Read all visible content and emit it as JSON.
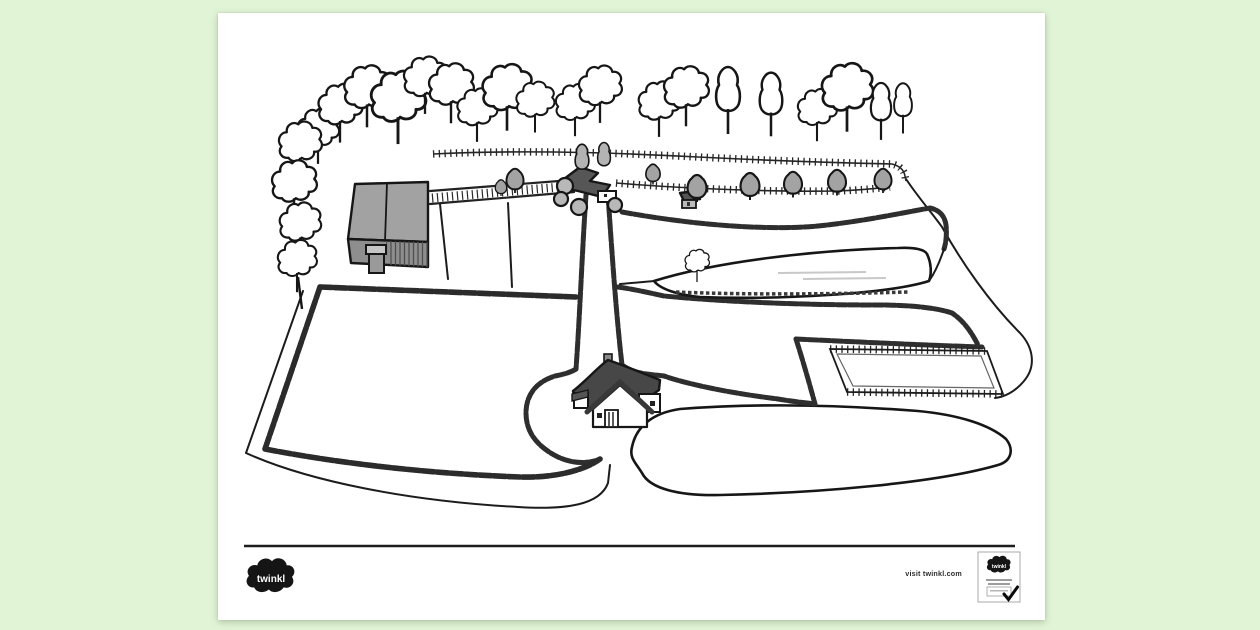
{
  "window": {
    "background_color": "#e2f4d6"
  },
  "paper": {
    "color": "#ffffff"
  },
  "illustration": {
    "alt": "Aerial black and white line drawing of a farm: a tree-lined boundary along the top, a grey barn on the left, farm buildings at a track junction, a farmhouse in the centre reached by a hedged driveway, hedged fields, a fenced paddock and an open meadow",
    "elements": [
      "tree row",
      "left tree cluster",
      "grey barn",
      "farm track",
      "junction farm buildings",
      "driveway",
      "farmhouse",
      "hedged field",
      "strip fields",
      "fenced paddock",
      "meadow outline",
      "small tree",
      "roadside bushes"
    ]
  },
  "footer": {
    "visit_text": "visit twinkl.com",
    "logo_text": "twinkl",
    "badge_logo_text": "twinkl"
  }
}
